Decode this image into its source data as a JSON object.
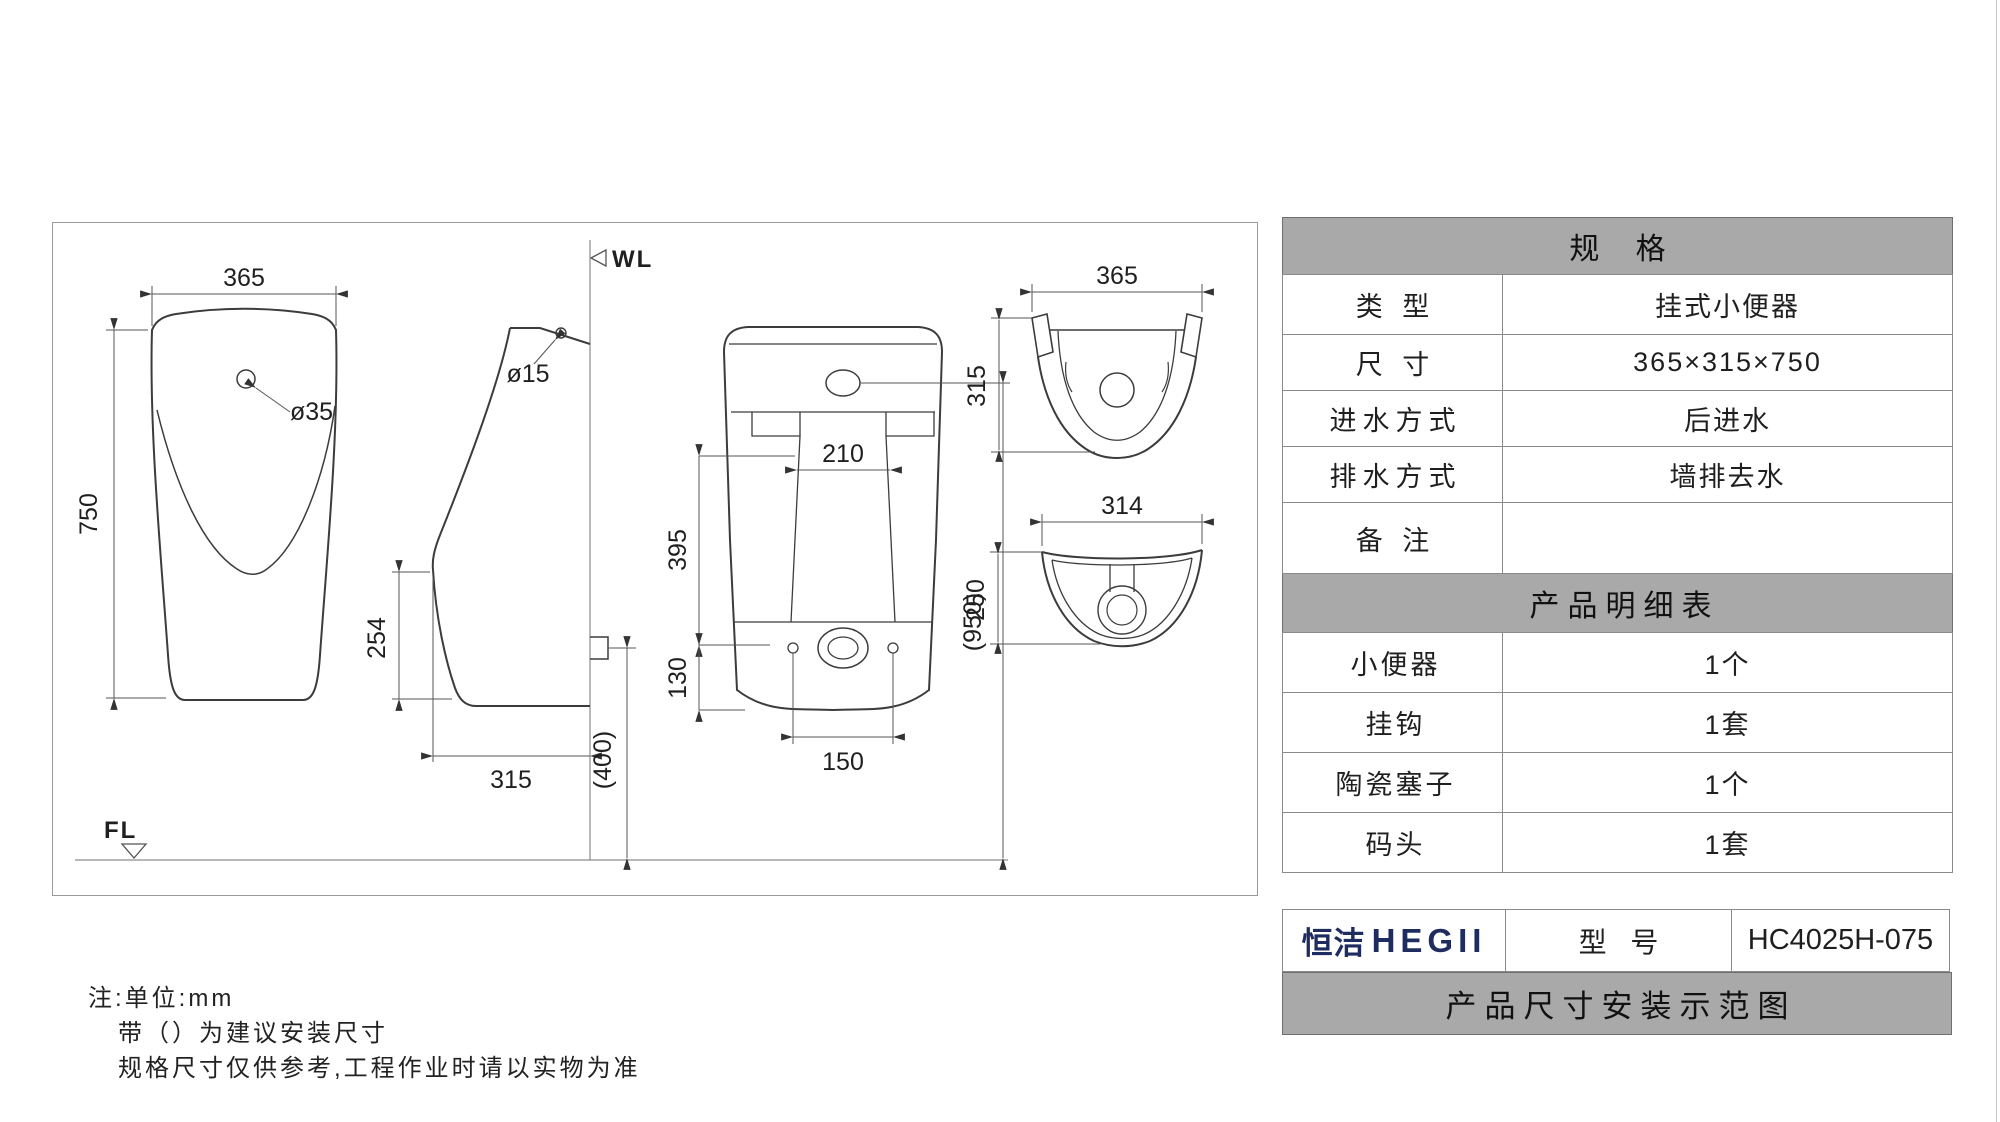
{
  "drawing": {
    "labels": {
      "wl": "WL",
      "fl": "FL"
    },
    "front_view": {
      "width_dim": "365",
      "height_dim": "750",
      "hole_dia": "ø35"
    },
    "side_view": {
      "hole_dia": "ø15",
      "lower_height_dim": "254",
      "depth_dim": "315",
      "outlet_height_dim": "(400)"
    },
    "rear_view": {
      "notch_width_dim": "210",
      "basin_height_dim": "395",
      "panel_height_dim": "130",
      "bolt_spacing_dim": "150",
      "inlet_height_dim": "(950)"
    },
    "top_view": {
      "width_dim": "365",
      "depth_dim": "315"
    },
    "bottom_view": {
      "width_dim": "314",
      "depth_dim": "250"
    }
  },
  "notes": {
    "line1": "注:单位:mm",
    "line2": "带（）为建议安装尺寸",
    "line3": "规格尺寸仅供参考,工程作业时请以实物为准"
  },
  "spec_table": {
    "title": "规  格",
    "rows": [
      {
        "label": "类  型",
        "value": "挂式小便器"
      },
      {
        "label": "尺  寸",
        "value": "365×315×750"
      },
      {
        "label": "进水方式",
        "value": "后进水"
      },
      {
        "label": "排水方式",
        "value": "墙排去水"
      },
      {
        "label": "备  注",
        "value": ""
      }
    ]
  },
  "parts_table": {
    "title": "产品明细表",
    "rows": [
      {
        "label": "小便器",
        "value": "1个"
      },
      {
        "label": "挂钩",
        "value": "1套"
      },
      {
        "label": "陶瓷塞子",
        "value": "1个"
      },
      {
        "label": "码头",
        "value": "1套"
      }
    ]
  },
  "footer": {
    "brand_cn": "恒洁",
    "brand_en": "HEGII",
    "model_label": "型  号",
    "model_value": "HC4025H-075",
    "caption": "产品尺寸安装示范图",
    "brand_color": "#1e2c5f"
  },
  "colors": {
    "header_gray": "#a9a9a9",
    "border_gray": "#8a8a8a",
    "line_dark": "#3c3c3c",
    "dim_line": "#555555"
  }
}
